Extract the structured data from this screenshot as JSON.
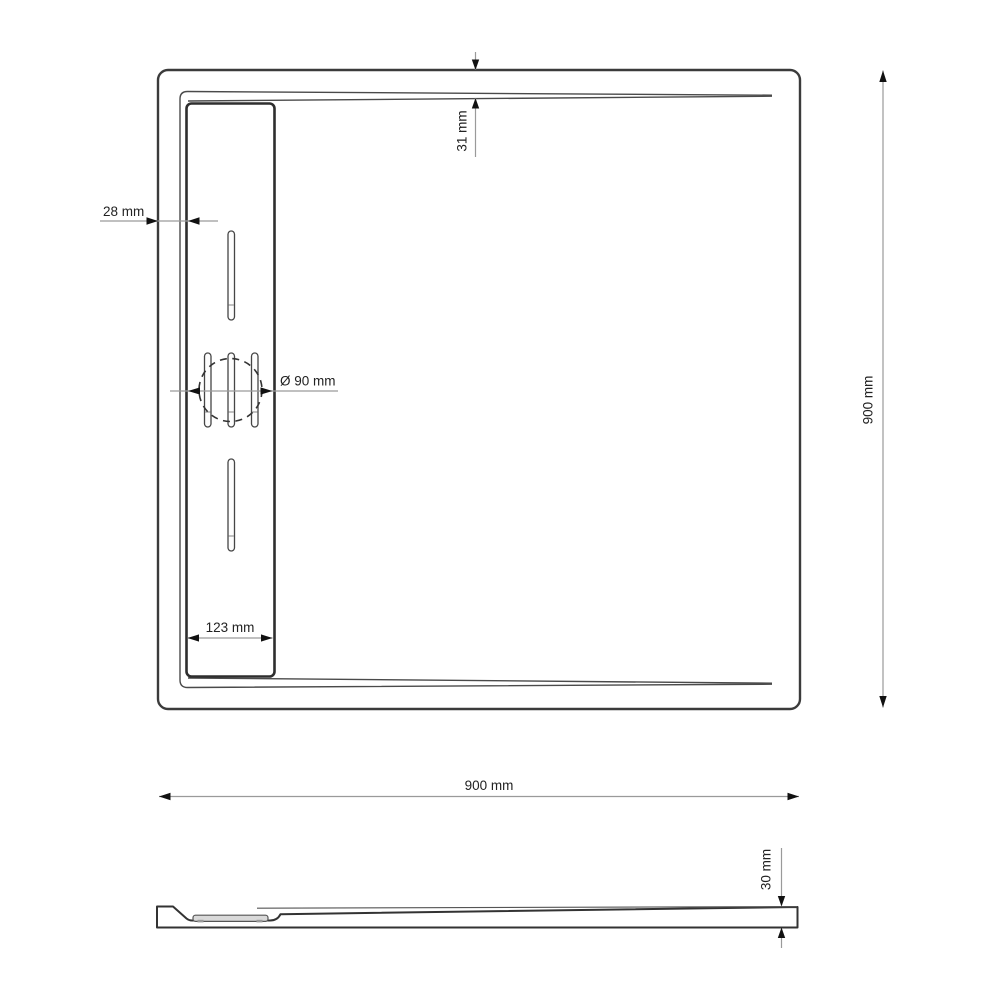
{
  "drawing": {
    "type": "technical-dimension-drawing",
    "subject": "square shower tray with linear drain",
    "colors": {
      "line": "#3b3b3b",
      "dimension_line": "#9a9a9a",
      "arrow": "#111111",
      "text": "#222222",
      "cover_fill": "#d9d9d9",
      "background": "#ffffff"
    },
    "top_view": {
      "dimensions": {
        "edge_to_channel": "28 mm",
        "rim_inset": "31 mm",
        "drain_diameter": "Ø 90 mm",
        "channel_width": "123 mm",
        "overall_depth": "900 mm"
      }
    },
    "side_view": {
      "dimensions": {
        "overall_width": "900 mm",
        "tray_height": "30 mm"
      }
    }
  }
}
